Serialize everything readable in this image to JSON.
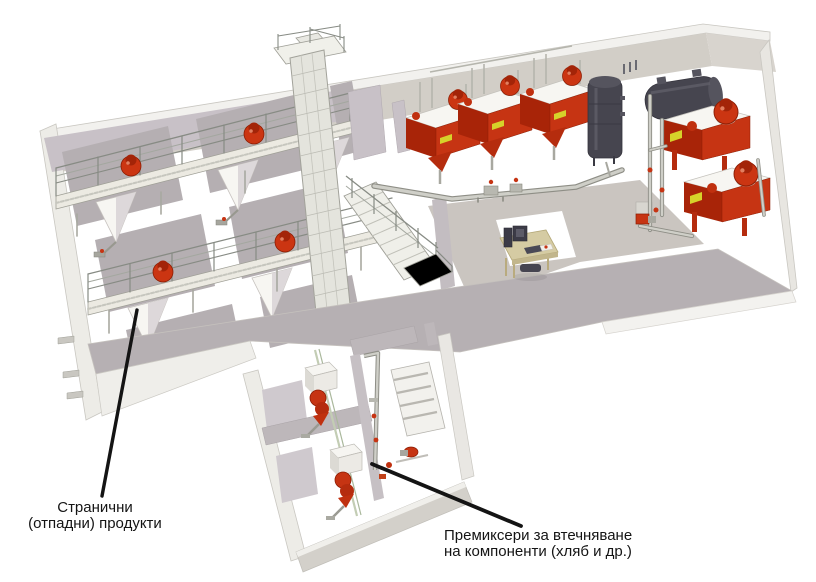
{
  "page": {
    "type": "isometric-plant-layout-diagram",
    "background": "#ffffff"
  },
  "annotations": {
    "side_products": {
      "text": "Странични (отпадни) продукти",
      "line1": "Странични",
      "line2": "(отпадни) продукти"
    },
    "premixers": {
      "text": "Премиксери за втечняване на компоненти (хляб и др.)",
      "line1": "Премиксери за втечняване",
      "line2": "на компоненти (хляб и др.)"
    }
  },
  "colors": {
    "accent_red": "#c63413",
    "dark_red": "#8c1d04",
    "tank_dark": "#46454f",
    "wall_warm_gray": "#d2cec7",
    "inner_wall_lavender": "#c8c1c7",
    "front_wall_gray": "#b6b0b3",
    "steel_light": "#e8e8e1",
    "pipe_gray": "#c3c3bc",
    "desk_tan": "#d5cba3",
    "sticker_yellow": "#d6d22a",
    "tube_green": "#c3cdb4",
    "label_text": "#141414"
  },
  "equipment": [
    "storage-bins-with-hoppers",
    "service-walkways-with-railings",
    "bucket-elevator-tower",
    "staircase",
    "dosing-mixers",
    "vertical-tank",
    "horizontal-tank",
    "control-desk-computer",
    "premixer-units",
    "piping-valves-pumps"
  ]
}
